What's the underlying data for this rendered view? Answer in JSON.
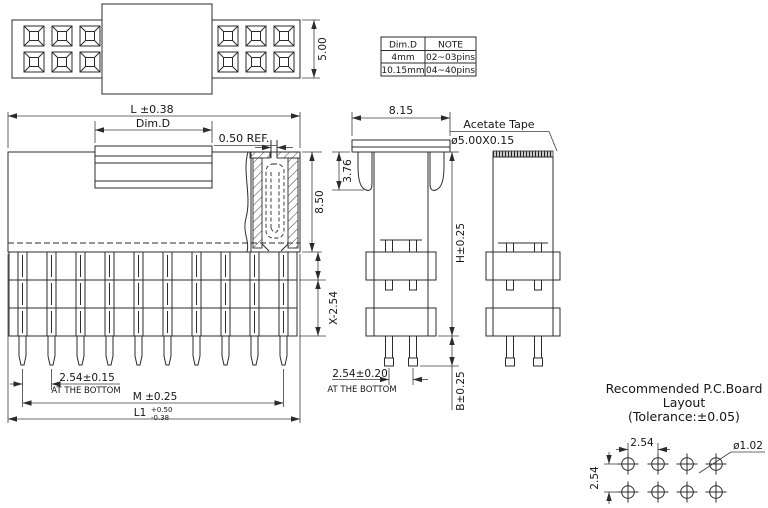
{
  "table": {
    "header": {
      "dim": "Dim.D",
      "note": "NOTE"
    },
    "rows": [
      {
        "dim": "4mm",
        "note": "02~03pins"
      },
      {
        "dim": "10.15mm",
        "note": "04~40pins"
      }
    ]
  },
  "top_view": {
    "height": "5.00"
  },
  "front_view": {
    "overall_width": "L ±0.38",
    "tape_width": "Dim.D",
    "slot": "0.50 REF.",
    "body_height": "8.50",
    "stack_height": "X-2.54",
    "pitch": "2.54±0.15",
    "pitch_note": "AT THE BOTTOM",
    "span": "M ±0.25",
    "l1": "L1",
    "l1_tol_plus": "+0.50",
    "l1_tol_minus": "-0.38"
  },
  "side_view": {
    "cap_width": "8.15",
    "flange_height": "3.76",
    "height": "H±0.25",
    "pitch": "2.54±0.20",
    "pitch_note": "AT THE BOTTOM",
    "tail": "B±0.25",
    "tape_label": "Acetate Tape",
    "tape_spec": "ø5.00X0.15"
  },
  "pcb": {
    "title1": "Recommended P.C.Board",
    "title2": "Layout",
    "title3": "(Tolerance:±0.05)",
    "pitch_x": "2.54",
    "pitch_y": "2.54",
    "hole": "ø1.02"
  }
}
